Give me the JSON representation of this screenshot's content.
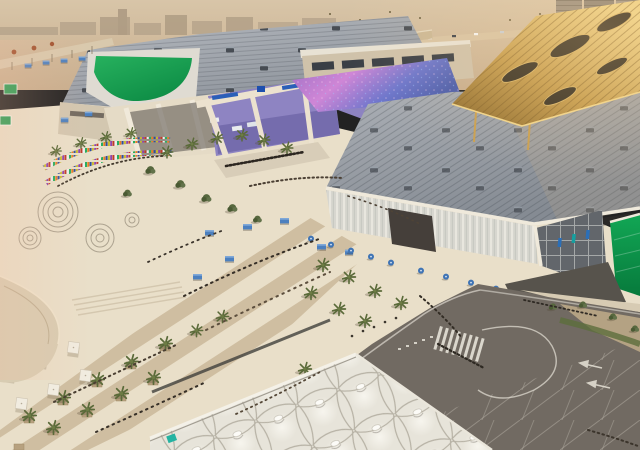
{
  "scene": {
    "type": "aerial-architectural-rendering",
    "landmarks": [
      "west-exhibition-hall",
      "east-exhibition-hall",
      "green-roof-banner",
      "iridescent-purple-roof",
      "gold-lattice-canopy",
      "entrance-portal",
      "flag-plaza",
      "palm-promenade",
      "tensile-fabric-canopy",
      "road-junction",
      "desert-skyline",
      "highrise-towers"
    ]
  },
  "palette": {
    "sky_top": "#d8c5a8",
    "sky_low": "#c8ae8e",
    "skyline": "#b3a189",
    "desert_road": "#d8c4a4",
    "roofA_light": "#b6bac0",
    "roofA_dark": "#8b9199",
    "roofB_light": "#aeb2b8",
    "roofB_dark": "#858b93",
    "green_banner_1": "#27b15e",
    "green_banner_2": "#0d8c45",
    "gold_1": "#eed388",
    "gold_2": "#c59c4d",
    "gold_3": "#8c6a2e",
    "irid_1": "#9a6fc4",
    "irid_2": "#cf86d6",
    "irid_3": "#6d76cc",
    "irid_4": "#4a5cab",
    "purple_wall": "#8e84c2",
    "facade_cream": "#e5dbc6",
    "fascia_white": "#efe9db",
    "clerestory_tan": "#cfc2aa",
    "window_dark": "#3a3f46",
    "louvre_glass": "#d7d6cf",
    "glass_dark": "#62666b",
    "green_glass_1": "#12a755",
    "green_glass_2": "#077a3c",
    "plaza_cream": "#e9dfc9",
    "stripe_tan": "#b59d78",
    "court_dark": "#57534c",
    "road_asphalt": "#716a62",
    "road_marking": "#e8e4d8",
    "sidewalk": "#d7cbb3",
    "gravel": "#b4a283",
    "hedge_green": "#5d6e3c",
    "tent_white": "#e7e4da",
    "tent_seam": "#b6b1a4",
    "palm_green": "#5a6a39",
    "tree_green": "#57683e",
    "kiosk_blue": "#4c80bf",
    "cafe_umbrella_blue": "#3f74b5",
    "umbrella_white": "#f1ece0",
    "crowd_dark": "#38322a",
    "channel_dark": "#41413c",
    "ramp_beige": "#d8ccb2",
    "teal_sign": "#25b3a2",
    "tower_grey": "#998e7f",
    "sign_green": "#2a9d55"
  },
  "flags": {
    "colors": [
      "#c0392b",
      "#ecf0f1",
      "#27ae60",
      "#e67e22",
      "#2e4ea1",
      "#c8b92e",
      "#8e44ad"
    ]
  }
}
